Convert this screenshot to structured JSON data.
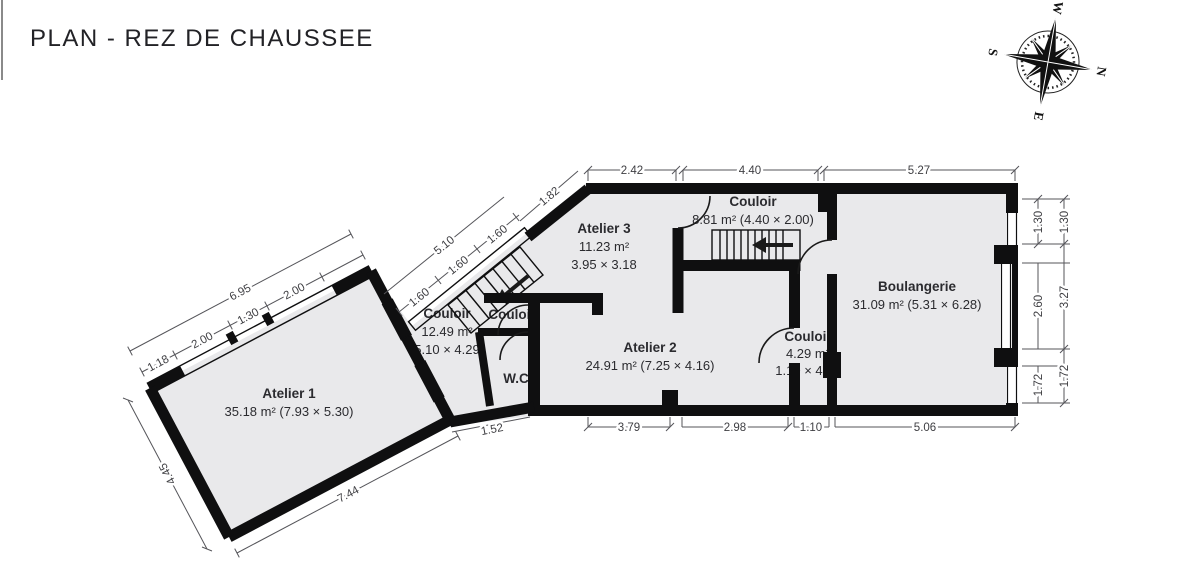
{
  "title": "PLAN - REZ DE CHAUSSEE",
  "compass": {
    "n": "N",
    "e": "E",
    "s": "S",
    "w": "W"
  },
  "rooms": {
    "atelier1": {
      "name": "Atelier 1",
      "line2": "35.18 m² (7.93 × 5.30)"
    },
    "atelier2": {
      "name": "Atelier 2",
      "line2": "24.91 m² (7.25 × 4.16)"
    },
    "atelier3": {
      "name": "Atelier 3",
      "line2": "11.23 m²",
      "line3": "3.95 × 3.18"
    },
    "boulangerie": {
      "name": "Boulangerie",
      "line2": "31.09 m² (5.31 × 6.28)"
    },
    "couloir_top": {
      "name": "Couloir",
      "line2": "8.81 m² (4.40 × 2.00)"
    },
    "couloir_main": {
      "name": "Couloir",
      "line2": "12.49 m²",
      "line3": "5.10 × 4.29"
    },
    "couloir_small": {
      "name": "Couloir",
      "line2": "4.29 m²",
      "line3": "1.10 × 4.16"
    },
    "vestibule": {
      "name": "Couloir"
    },
    "wc": {
      "name": "W.C"
    }
  },
  "dimensions": {
    "top": [
      "2.42",
      "4.40",
      "5.27"
    ],
    "bottom": [
      "3.79",
      "2.98",
      "1.10",
      "5.06"
    ],
    "right_inner": [
      "1.30",
      "2.60",
      "1.72"
    ],
    "right_outer": [
      "1.30",
      "3.27",
      "1.72"
    ],
    "atelier1_total": "6.95",
    "atelier1_sections": [
      "1.18",
      "2.00",
      "1.30",
      "2.00"
    ],
    "atelier1_left": "4.45",
    "atelier1_bottom": "7.44",
    "wc_bottom": "1.52",
    "stair_total": "5.10",
    "stair_sections": [
      "1.60",
      "1.60",
      "1.60"
    ],
    "stair_top": "1.82"
  },
  "colors": {
    "floor": "#e9e9eb",
    "wall": "#0f0f10",
    "dim": "#55555a"
  }
}
